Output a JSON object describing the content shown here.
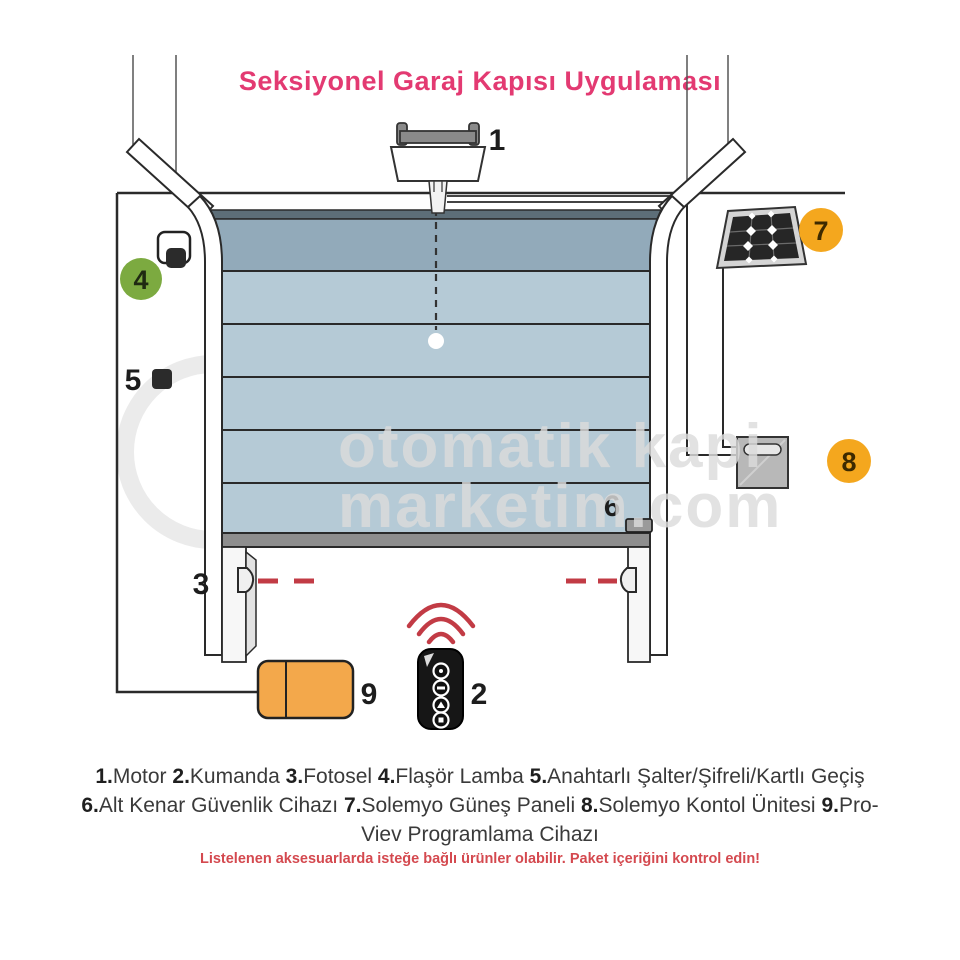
{
  "title": "Seksiyonel Garaj Kapısı Uygulaması",
  "watermark": {
    "line1": "otomatik kapi",
    "line2": "marketim.com"
  },
  "callouts": {
    "c1": "1",
    "c2": "2",
    "c3": "3",
    "c4": "4",
    "c5": "5",
    "c6": "6",
    "c7": "7",
    "c8": "8",
    "c9": "9"
  },
  "legend": {
    "items": [
      {
        "num": "1.",
        "label": "Motor"
      },
      {
        "num": "2.",
        "label": "Kumanda"
      },
      {
        "num": "3.",
        "label": "Fotosel"
      },
      {
        "num": "4.",
        "label": "Flaşör Lamba"
      },
      {
        "num": "5.",
        "label": "Anahtarlı Şalter/Şifreli/Kartlı Geçiş"
      },
      {
        "num": "6.",
        "label": "Alt Kenar Güvenlik Cihazı"
      },
      {
        "num": "7.",
        "label": "Solemyo Güneş Paneli"
      },
      {
        "num": "8.",
        "label": "Solemyo Kontol Ünitesi"
      },
      {
        "num": "9.",
        "label": "Pro-Viev Programlama Cihazı"
      }
    ],
    "note": "Listelenen aksesuarlarda isteğe bağlı ürünler olabilir. Paket içeriğini kontrol edin!"
  },
  "colors": {
    "title_pink": "#e33a72",
    "badge_green": "#7caa40",
    "badge_orange": "#f4a71e",
    "device_orange": "#f3a84b",
    "door_panel_light": "#b5cad6",
    "door_panel_dark": "#92aaba",
    "door_header": "#5d6e78",
    "beam_red": "#c23b45",
    "note_red": "#d4494f",
    "watermark_gray": "#dcdcdc"
  }
}
